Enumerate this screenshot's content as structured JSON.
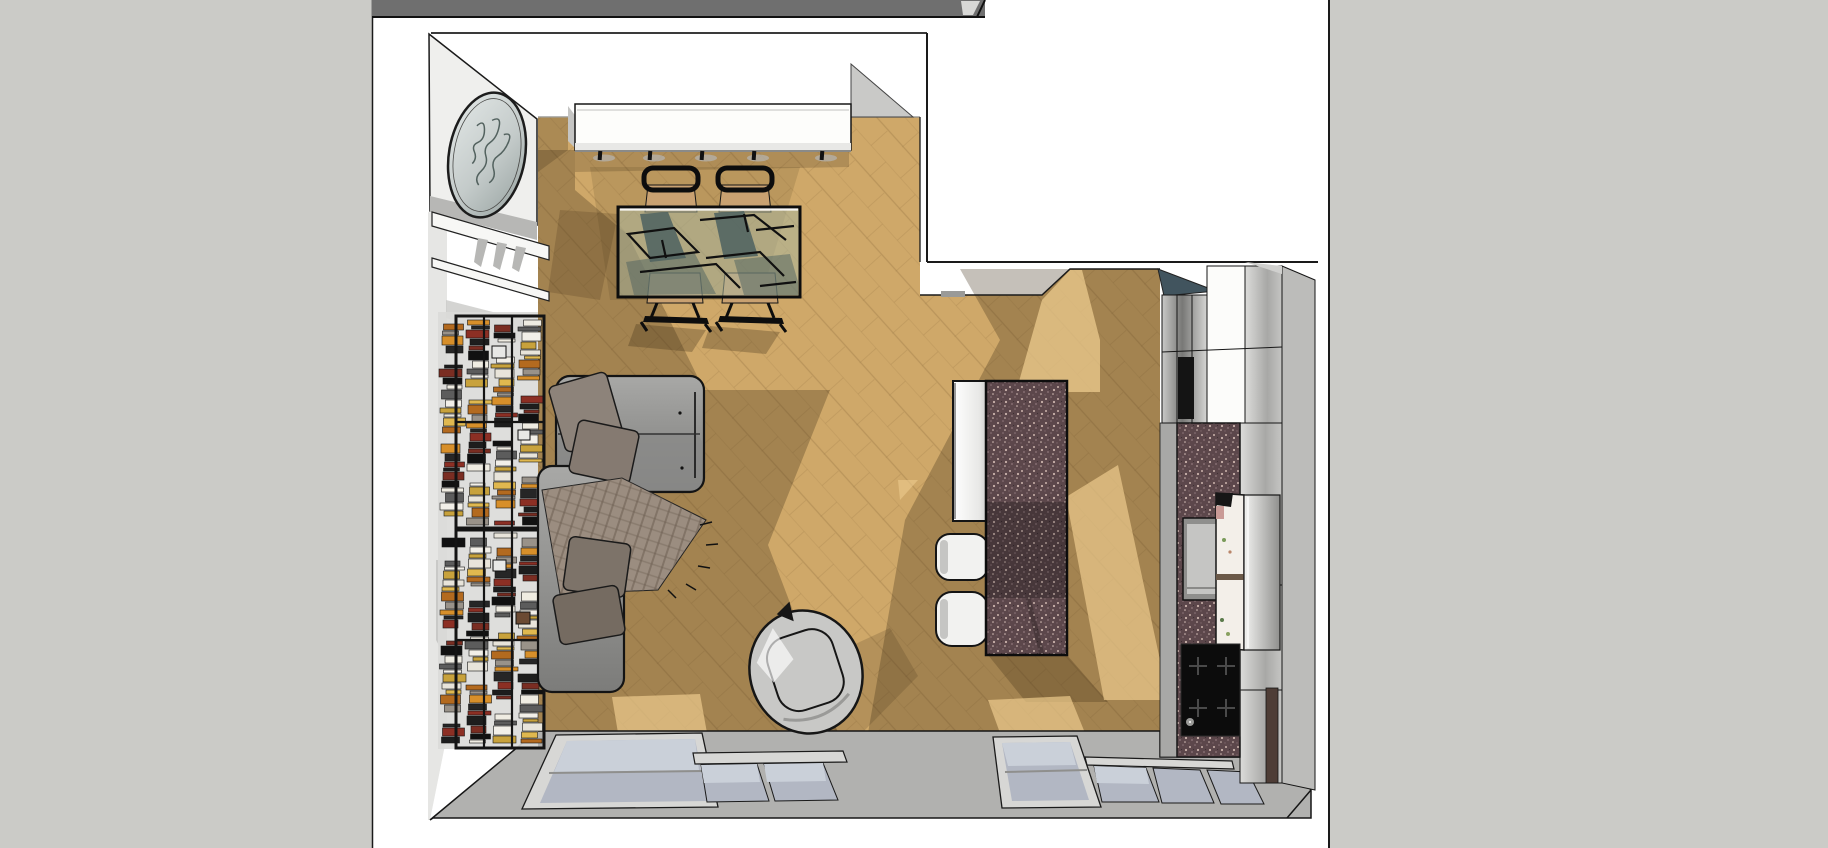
{
  "meta": {
    "view_type": "3d-model-top-view",
    "description": "Top-down 3D rendered view of a studio apartment (living room with bookshelf wall, sofa and lounge chair, dining nook with glass table, kitchen island and galley kitchen) shown on a white sheet over a gray canvas"
  },
  "palette": {
    "canvas_bg": "#cbcbc7",
    "sheet": "#ffffff",
    "sheet_border": "#1a1a1a",
    "top_wall_bar": "#6f6f6f",
    "top_wall_notch": "#d8d8d6",
    "floor_wood": "#cfa869",
    "floor_plank_line": "#8a6a3c",
    "floor_shadow": "#3f2f16",
    "floor_sunlight": "#eccb8d",
    "wall_white": "#efefed",
    "wall_ledge": "#f7f7f5",
    "wall_shade": "#b7b7b5",
    "wall_gray": "#b1b1af",
    "left_wall": "#e6e6e4",
    "corner_sliver": "#c9c9c7",
    "accent_teal": "#41545e",
    "granite_base": "#5c474b",
    "granite_speckle": "#cbb3ac",
    "granite_speckle2": "#8f777b",
    "sofa_light": "#a8a8a6",
    "sofa_dark": "#7c7c7a",
    "pillow_taupe": "#8d837a",
    "pillow_taupe2": "#857a71",
    "pillow_dark": "#7d7369",
    "pillow_dark2": "#756b61",
    "throw_plaid": "#9b8d80",
    "plaid_line": "#6d5f52",
    "chair_wood": "#c9a171",
    "frame_black": "#141414",
    "table_glass": "#aab69e",
    "table_ghost": "#4e6160",
    "window_glass": "#b2b7c3",
    "window_glass_light": "#cad0d9",
    "window_frame": "#d7d7d5",
    "steel_light": "#f2f2f0",
    "steel_dark": "#8f8f8d",
    "cabinet_white": "#fcfcfa",
    "stool_white": "#f2f2f0",
    "pouf_gray": "#c8c8c6",
    "cooktop_black": "#0c0c0c",
    "fridge_face": "#f3efe9",
    "wood_strip_dark": "#4e3d36",
    "sink_outer": "#8f8f8d",
    "sink_inner": "#c5c5c3",
    "mirror_glass_light": "#e3e8e7",
    "mirror_glass_dark": "#97a2a0",
    "mirror_script": "#53625f"
  },
  "bookshelf": {
    "units": [
      {
        "top": 318,
        "bottom": 526
      },
      {
        "top": 532,
        "bottom": 744
      }
    ],
    "columns": [
      440,
      466,
      492,
      518
    ],
    "column_width": 25,
    "book_colors": [
      "#e8e4da",
      "#111111",
      "#d78f2a",
      "#c8a23c",
      "#7a2d22",
      "#999289",
      "#f2efe8",
      "#1d1d1d",
      "#b36a1f",
      "#5c5c5c",
      "#8c2f24",
      "#e0b84f",
      "#efece2",
      "#262626"
    ]
  },
  "scene": {
    "objects": [
      {
        "name": "paper-sheet"
      },
      {
        "name": "top-wall-bar"
      },
      {
        "name": "wood-floor"
      },
      {
        "name": "wall-mirror"
      },
      {
        "name": "wall-sideboard"
      },
      {
        "name": "dining-table"
      },
      {
        "name": "dining-chairs",
        "count": 4
      },
      {
        "name": "bookshelf-units",
        "count": 2
      },
      {
        "name": "sofa"
      },
      {
        "name": "throw-blanket"
      },
      {
        "name": "sofa-pillows",
        "count": 4
      },
      {
        "name": "lounge-chair"
      },
      {
        "name": "kitchen-island"
      },
      {
        "name": "bar-stools",
        "count": 2
      },
      {
        "name": "accent-wall"
      },
      {
        "name": "tall-cabinets"
      },
      {
        "name": "kitchen-counter"
      },
      {
        "name": "sink"
      },
      {
        "name": "refrigerator"
      },
      {
        "name": "cooktop"
      },
      {
        "name": "windows-left",
        "panes": 3
      },
      {
        "name": "windows-right",
        "panes": 4
      }
    ]
  }
}
